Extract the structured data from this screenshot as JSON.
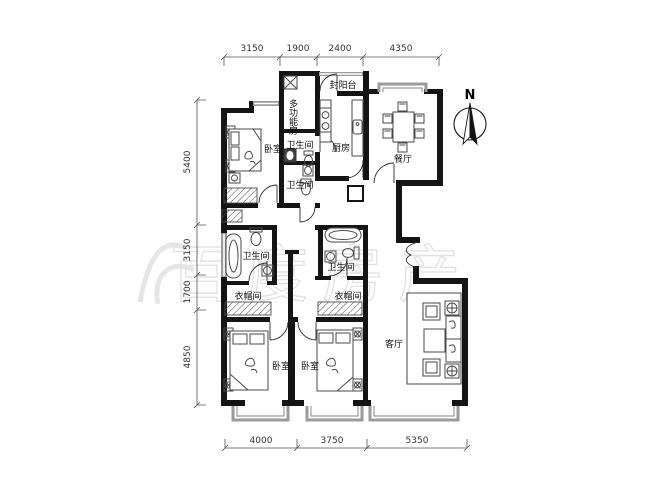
{
  "rooms": {
    "bedroom_top": "卧室",
    "multi_function": "多功能房",
    "balcony": "封阳台",
    "kitchen": "厨房",
    "dining": "餐厅",
    "bath_upper_1": "卫生间",
    "bath_upper_2": "卫生间",
    "bath_mid_left": "卫生间",
    "bath_mid_right": "卫生间",
    "cloak_left": "衣帽间",
    "cloak_right": "衣帽间",
    "bedroom_bottom_left": "卧室",
    "bedroom_bottom_mid": "卧室",
    "living": "客厅"
  },
  "compass": {
    "north": "N"
  },
  "dimensions": {
    "top": [
      "3150",
      "1900",
      "2400",
      "4350"
    ],
    "left": [
      "5400",
      "3150",
      "1700",
      "4850"
    ],
    "bottom": [
      "4000",
      "3750",
      "5350"
    ]
  },
  "watermark": {
    "text": "百度房产"
  },
  "colors": {
    "wall": "#141414",
    "window": "#9b9b9b",
    "furniture": "#4a4a4a",
    "dimension": "#555555",
    "watermark": "#cdcdcd",
    "background": "#ffffff"
  }
}
